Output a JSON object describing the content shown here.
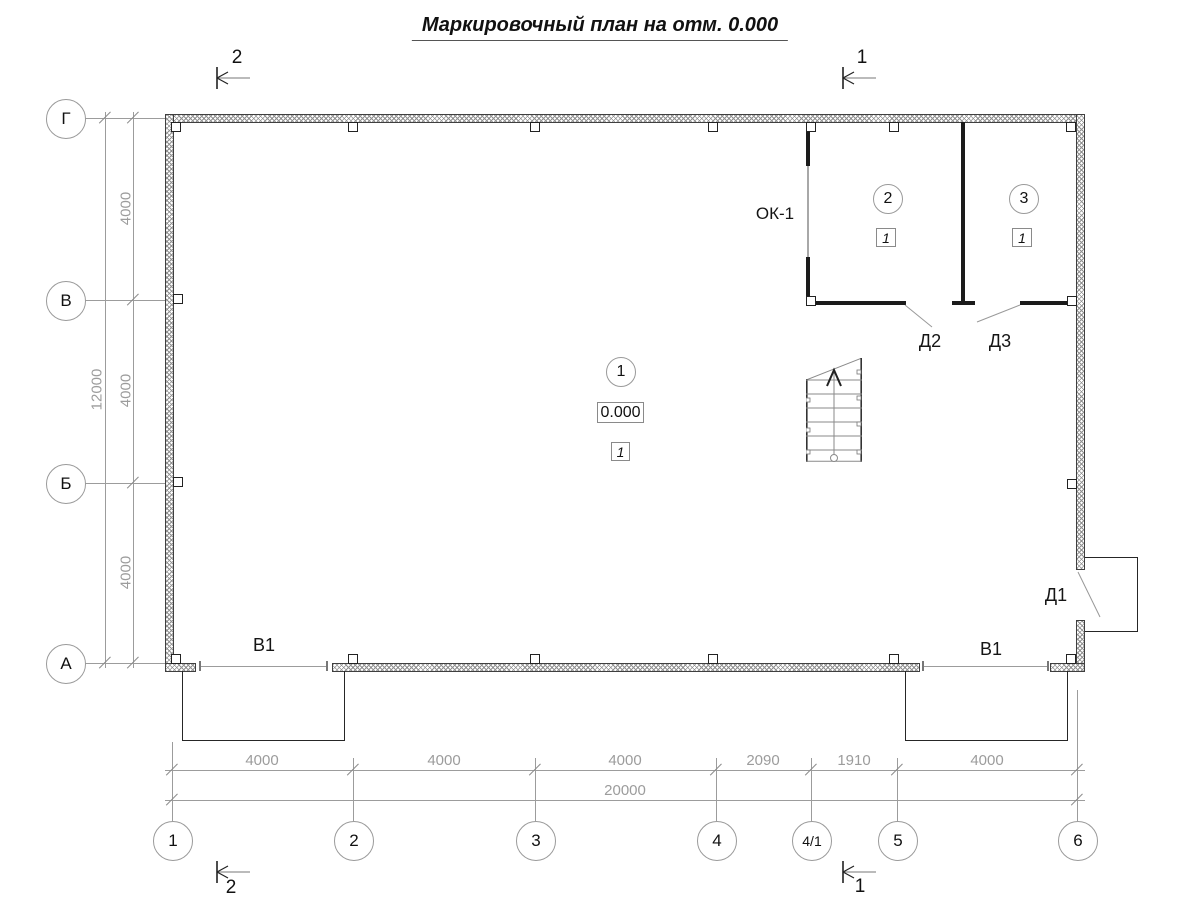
{
  "title": "Маркировочный план на отм. 0.000",
  "axes": {
    "rows": [
      "Г",
      "В",
      "Б",
      "А"
    ],
    "cols": [
      "1",
      "2",
      "3",
      "4",
      "4/1",
      "5",
      "6"
    ]
  },
  "dimensions": {
    "left_segments": [
      "4000",
      "4000",
      "4000"
    ],
    "left_total": "12000",
    "bottom_segments": [
      "4000",
      "4000",
      "4000",
      "2090",
      "1910",
      "4000"
    ],
    "bottom_total": "20000"
  },
  "rooms": [
    {
      "number": "1",
      "level": "0.000",
      "finish": "1"
    },
    {
      "number": "2",
      "finish": "1"
    },
    {
      "number": "3",
      "finish": "1"
    }
  ],
  "marks": {
    "window": "ОК-1",
    "door1": "Д1",
    "door2": "Д2",
    "door3": "Д3",
    "gate_left": "В1",
    "gate_right": "В1"
  },
  "sections": {
    "top_left": "2",
    "top_right": "1",
    "bottom_left": "2",
    "bottom_right": "1"
  }
}
